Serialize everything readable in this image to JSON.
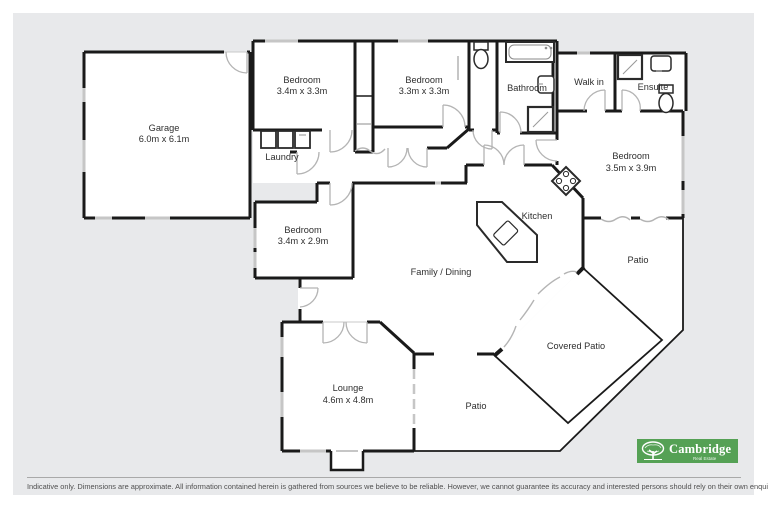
{
  "rooms": {
    "garage": {
      "name": "Garage",
      "dims": "6.0m x 6.1m"
    },
    "bedroom_top1": {
      "name": "Bedroom",
      "dims": "3.4m x 3.3m"
    },
    "bedroom_top2": {
      "name": "Bedroom",
      "dims": "3.3m x 3.3m"
    },
    "bathroom": {
      "name": "Bathroom"
    },
    "walk_in": {
      "name": "Walk in"
    },
    "ensuite": {
      "name": "Ensuite"
    },
    "bedroom_right": {
      "name": "Bedroom",
      "dims": "3.5m x 3.9m"
    },
    "laundry": {
      "name": "Laundry"
    },
    "bedroom_mid": {
      "name": "Bedroom",
      "dims": "3.4m x 2.9m"
    },
    "kitchen": {
      "name": "Kitchen"
    },
    "family_dining": {
      "name": "Family / Dining"
    },
    "patio_right": {
      "name": "Patio"
    },
    "covered_patio": {
      "name": "Covered Patio"
    },
    "patio_bottom": {
      "name": "Patio"
    },
    "lounge": {
      "name": "Lounge",
      "dims": "4.6m x 4.8m"
    }
  },
  "branding": {
    "name": "Cambridge",
    "tagline": "Real Estate",
    "color": "#55a155"
  },
  "footer": {
    "disclaimer": "Indicative only. Dimensions are approximate. All information contained herein is gathered from sources we believe to be reliable. However, we cannot guarantee its accuracy and interested persons should rely on their own enquiries."
  },
  "colors": {
    "wall": "#1a1a1a",
    "background": "#e8e9eb",
    "floor": "#ffffff"
  }
}
